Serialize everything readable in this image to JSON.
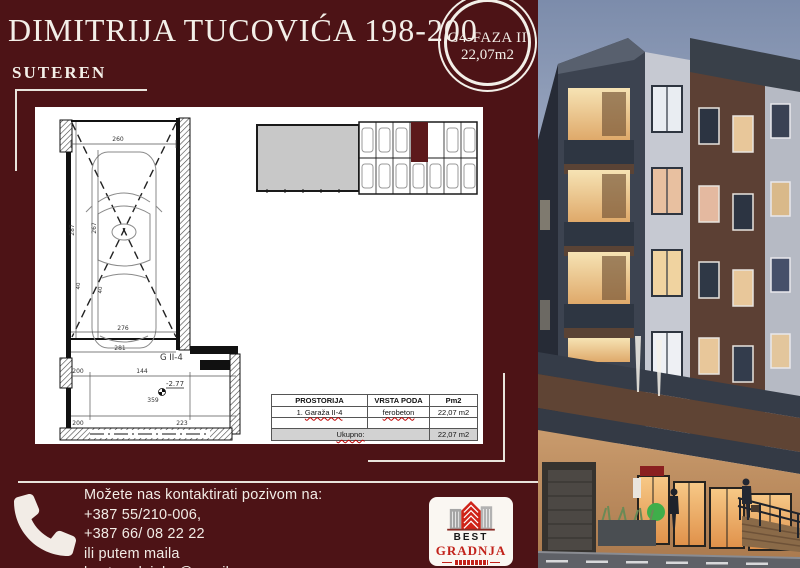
{
  "page": {
    "title": "DIMITRIJA TUCOVIĆA 198-200",
    "floor_label": "SUTEREN"
  },
  "badge": {
    "line1": "G4-FAZA II",
    "line2": "22,07m2"
  },
  "floor_plan": {
    "unit_label": "G II-4",
    "elevation": "-2.77",
    "dims": {
      "top_width": "260",
      "left_height": "287",
      "inner_height": "267",
      "offset_a": "40",
      "offset_b": "40",
      "car_width": "276",
      "mid_width": "281",
      "room_a": "200",
      "room_b": "144",
      "room_c": "359",
      "room_d": "223",
      "room_e": "200"
    }
  },
  "table": {
    "headers": [
      "PROSTORIJA",
      "VRSTA PODA",
      "Pm2"
    ],
    "rows": [
      {
        "name_prefix": "1. ",
        "name": "Garaža II-4",
        "floor_type": "ferobeton",
        "area": "22,07 m2"
      }
    ],
    "total_label": "Ukupno:",
    "total_area": "22,07 m2"
  },
  "contact": {
    "intro": "Možete nas kontaktirati pozivom na:",
    "phone1": "+387 55/210-006,",
    "phone2": "+387 66/ 08 22 22",
    "mail_intro": "ili putem maila",
    "email": "bestgradnjabn@gmail.com"
  },
  "logo": {
    "name_top": "BEST",
    "name_bottom": "GRADNJA"
  },
  "colors": {
    "background_maroon": "#4d1316",
    "highlight_unit": "#5c191b",
    "logo_red": "#c2221a",
    "spellcheck_red": "#c00000",
    "paper_white": "#ffffff",
    "table_total_gray": "#d2d2d2",
    "keyplan_gray": "#c8c8c8",
    "warm_window": "#f0d3a0"
  }
}
